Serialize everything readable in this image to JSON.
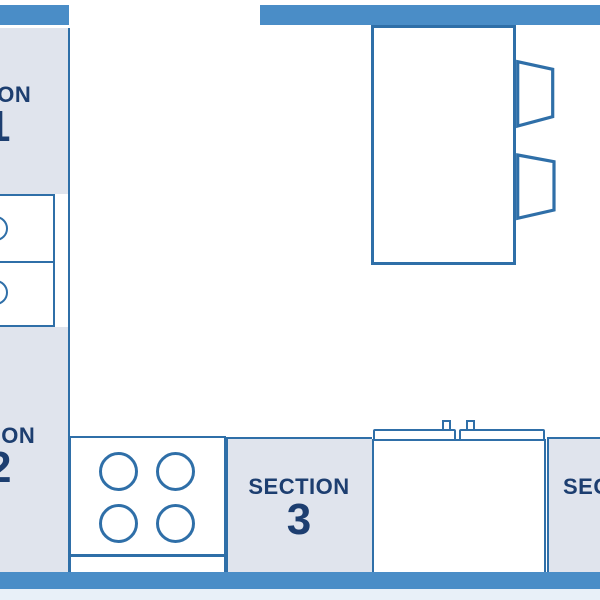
{
  "title": "Kitchen floor plan with numbered sections",
  "colors": {
    "wall": "#4a8dc7",
    "line": "#2f6fa8",
    "panel": "#e0e4ed",
    "text": "#1d3e70",
    "floor": "#ffffff",
    "floor_edge": "#e8f0f8"
  },
  "sections": [
    {
      "label": "SECTION",
      "number": "1",
      "position": "left counter, top (label clipped at left edge)"
    },
    {
      "label": "SECTION",
      "number": "2",
      "position": "left counter, bottom (label clipped at left edge)"
    },
    {
      "label": "SECTION",
      "number": "3",
      "position": "bottom counter, middle"
    },
    {
      "label": "SECTION",
      "number": "4",
      "position": "bottom counter, right (label clipped at right edge)"
    }
  ],
  "fixtures": {
    "island": {
      "name": "kitchen-island",
      "chairs": 2
    },
    "stove": {
      "name": "four-burner-stove",
      "burners": 4
    },
    "sink": {
      "name": "double-sink",
      "basins": 2,
      "taps": 2
    },
    "left_unit": {
      "name": "double-basin-unit",
      "basins": 2
    }
  },
  "walls": {
    "top_left": true,
    "top_right": true,
    "bottom": true,
    "door_opening": "top wall between left counter and right wall segment"
  }
}
